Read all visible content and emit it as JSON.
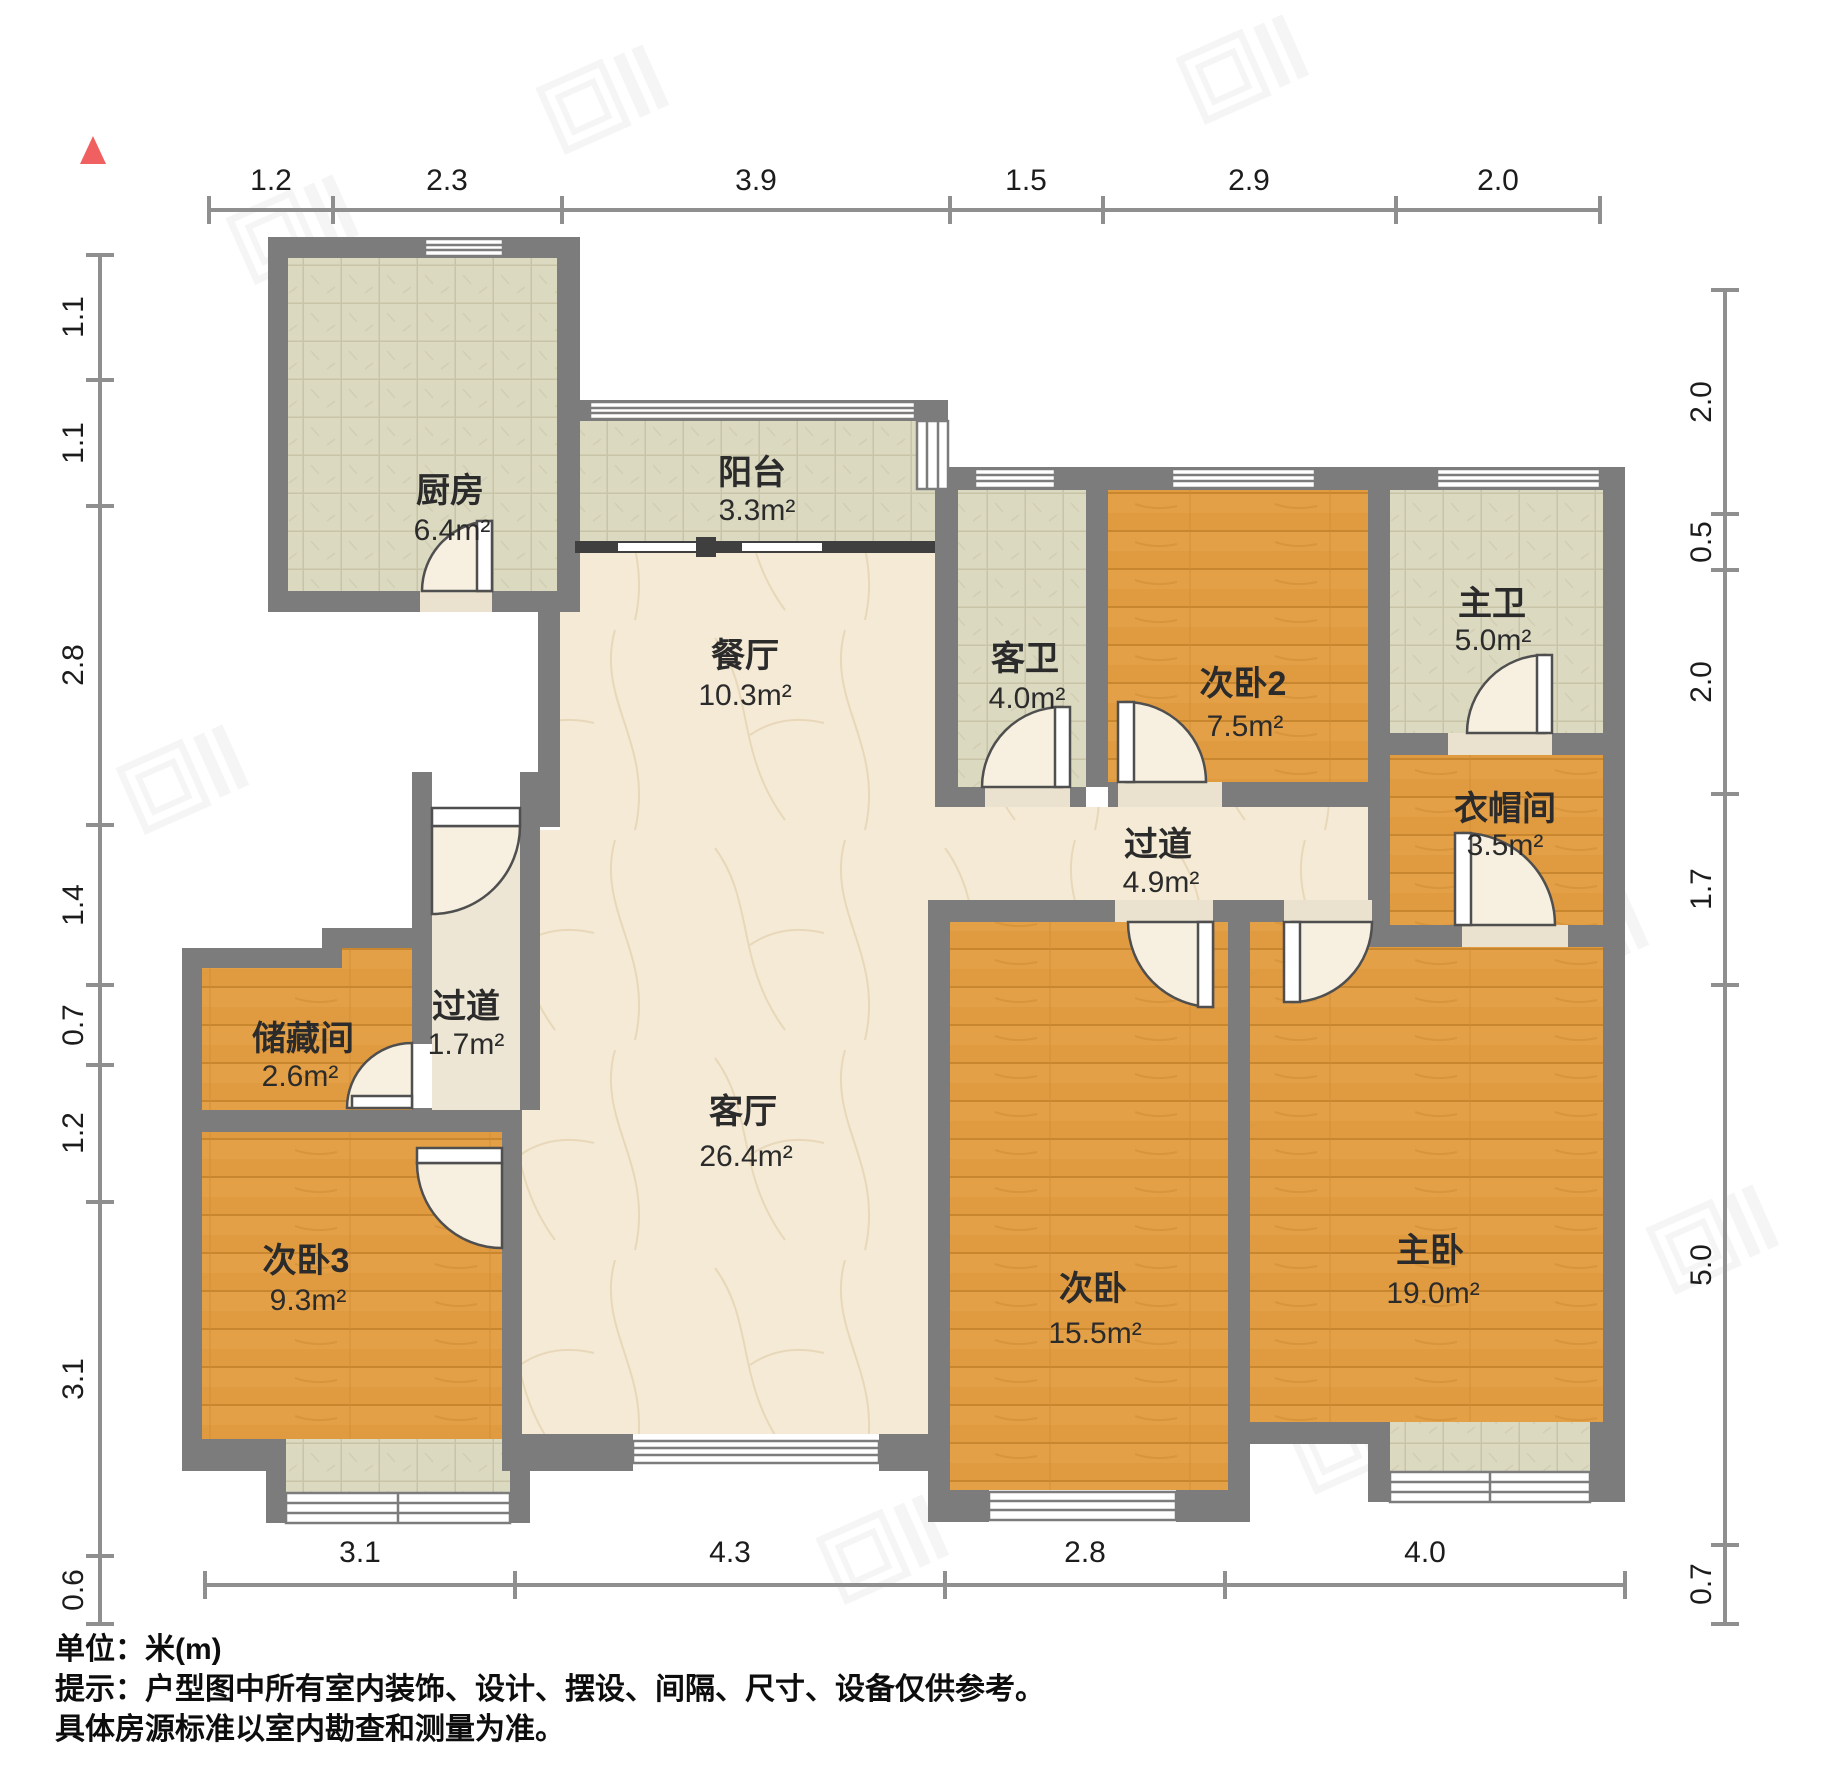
{
  "rooms": [
    {
      "id": "kitchen",
      "name": "厨房",
      "area": "6.4m²"
    },
    {
      "id": "balcony",
      "name": "阳台",
      "area": "3.3m²"
    },
    {
      "id": "dining",
      "name": "餐厅",
      "area": "10.3m²"
    },
    {
      "id": "guest-bath",
      "name": "客卫",
      "area": "4.0m²"
    },
    {
      "id": "bedroom2",
      "name": "次卧2",
      "area": "7.5m²"
    },
    {
      "id": "master-bath",
      "name": "主卫",
      "area": "5.0m²"
    },
    {
      "id": "cloakroom",
      "name": "衣帽间",
      "area": "3.5m²"
    },
    {
      "id": "hallway",
      "name": "过道",
      "area": "4.9m²"
    },
    {
      "id": "vestibule",
      "name": "过道",
      "area": "1.7m²"
    },
    {
      "id": "storage",
      "name": "储藏间",
      "area": "2.6m²"
    },
    {
      "id": "living",
      "name": "客厅",
      "area": "26.4m²"
    },
    {
      "id": "bedroom3",
      "name": "次卧3",
      "area": "9.3m²"
    },
    {
      "id": "bedroom1",
      "name": "次卧",
      "area": "15.5m²"
    },
    {
      "id": "master-bedroom",
      "name": "主卧",
      "area": "19.0m²"
    }
  ],
  "dims": {
    "top": [
      "1.2",
      "2.3",
      "3.9",
      "1.5",
      "2.9",
      "2.0"
    ],
    "left": [
      "1.1",
      "1.1",
      "2.8",
      "1.4",
      "0.7",
      "1.2",
      "3.1",
      "0.6"
    ],
    "right": [
      "2.0",
      "0.5",
      "2.0",
      "1.7",
      "5.0",
      "0.7"
    ],
    "bottom": [
      "3.1",
      "4.3",
      "2.8",
      "4.0"
    ]
  },
  "footer": {
    "unit": "单位：米(m)",
    "tip1": "提示：户型图中所有室内装饰、设计、摆设、间隔、尺寸、设备仅供参考。",
    "tip2": "具体房源标准以室内勘查和测量为准。"
  },
  "colors": {
    "wall": "#7c7c7c",
    "wood_floor": "#e09a40",
    "tile_floor": "#dcd9c1",
    "marble_floor": "#f4ead6",
    "north_marker_red": "#f16060"
  }
}
